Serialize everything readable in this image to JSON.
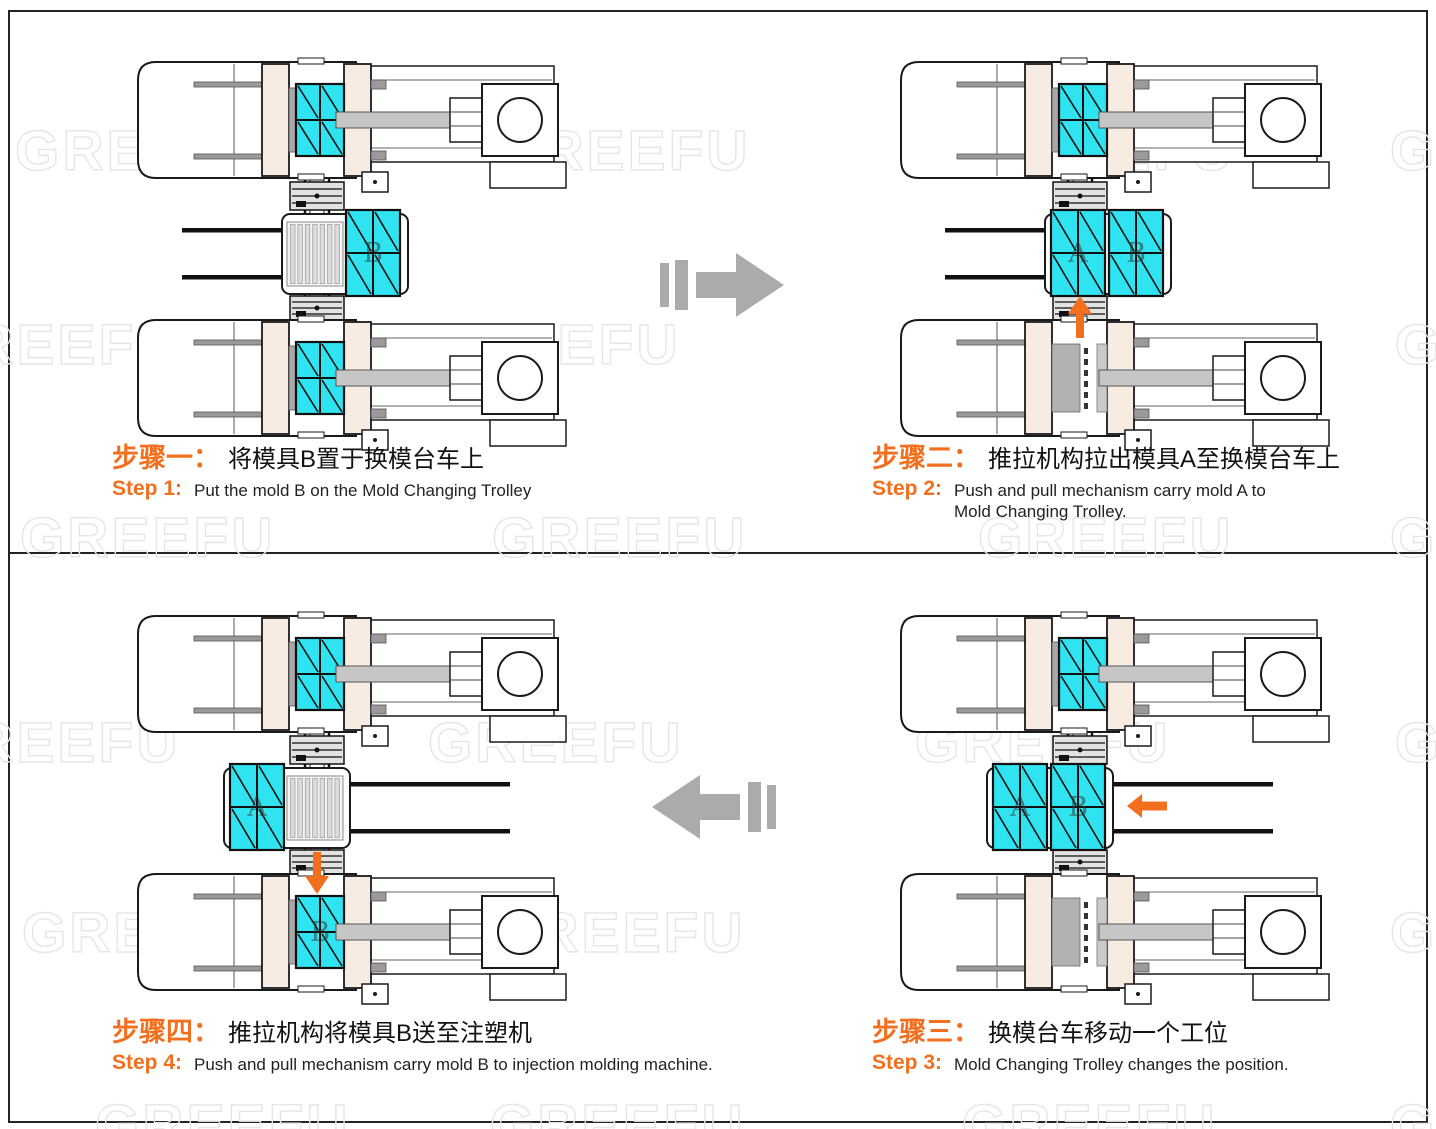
{
  "watermark": {
    "text": "GREEFU"
  },
  "colors": {
    "mold_cyan": "#2FE3F0",
    "platen_cream": "#F7EBE2",
    "orange": "#F26F1D",
    "flow_arrow_gray": "#ABABAB",
    "line": "#1a1a1a"
  },
  "steps": [
    {
      "id": "step-1",
      "quadrant": "top-left",
      "zh_label": "步骤一：",
      "zh_text": "将模具B置于换模台车上",
      "en_label": "Step 1:",
      "en_text": "Put the mold B on the Mold Changing Trolley"
    },
    {
      "id": "step-2",
      "quadrant": "top-right",
      "zh_label": "步骤二：",
      "zh_text": "推拉机构拉出模具A至换模台车上",
      "en_label": "Step 2:",
      "en_text": "Push and pull mechanism carry mold A to\nMold Changing Trolley."
    },
    {
      "id": "step-3",
      "quadrant": "bottom-right",
      "zh_label": "步骤三：",
      "zh_text": "换模台车移动一个工位",
      "en_label": "Step 3:",
      "en_text": "Mold Changing Trolley changes the position."
    },
    {
      "id": "step-4",
      "quadrant": "bottom-left",
      "zh_label": "步骤四：",
      "zh_text": "推拉机构将模具B送至注塑机",
      "en_label": "Step 4:",
      "en_text": "Push and pull mechanism carry mold B to injection molding machine."
    }
  ],
  "diagrams": {
    "tl": {
      "step": "step-1",
      "offset_x": 0,
      "top_machine": {
        "has_mold": true,
        "mold_label": ""
      },
      "bottom_machine": {
        "has_mold": true,
        "mold_label": ""
      },
      "trolley": {
        "position": "right",
        "forks": "left",
        "stations": [
          {
            "type": "rollers",
            "label": ""
          },
          {
            "type": "mold",
            "label": "B"
          }
        ]
      },
      "arrow": ""
    },
    "tr": {
      "step": "step-2",
      "offset_x": -55,
      "top_machine": {
        "has_mold": true,
        "mold_label": ""
      },
      "bottom_machine": {
        "has_mold": false,
        "mold_label": ""
      },
      "trolley": {
        "position": "right",
        "forks": "left",
        "stations": [
          {
            "type": "mold",
            "label": "A"
          },
          {
            "type": "mold",
            "label": "B"
          }
        ]
      },
      "arrow": "up"
    },
    "br": {
      "step": "step-3",
      "offset_x": -55,
      "top_machine": {
        "has_mold": true,
        "mold_label": ""
      },
      "bottom_machine": {
        "has_mold": false,
        "mold_label": ""
      },
      "trolley": {
        "position": "left",
        "forks": "right",
        "stations": [
          {
            "type": "mold",
            "label": "A"
          },
          {
            "type": "mold",
            "label": "B"
          }
        ]
      },
      "arrow": "left"
    },
    "bl": {
      "step": "step-4",
      "offset_x": 0,
      "top_machine": {
        "has_mold": true,
        "mold_label": ""
      },
      "bottom_machine": {
        "has_mold": true,
        "mold_label": "B"
      },
      "trolley": {
        "position": "left",
        "forks": "right",
        "stations": [
          {
            "type": "mold",
            "label": "A"
          },
          {
            "type": "rollers",
            "label": ""
          }
        ]
      },
      "arrow": "down"
    }
  },
  "flow_arrows": [
    {
      "id": "flow-top",
      "direction": "right"
    },
    {
      "id": "flow-bottom",
      "direction": "left"
    }
  ]
}
